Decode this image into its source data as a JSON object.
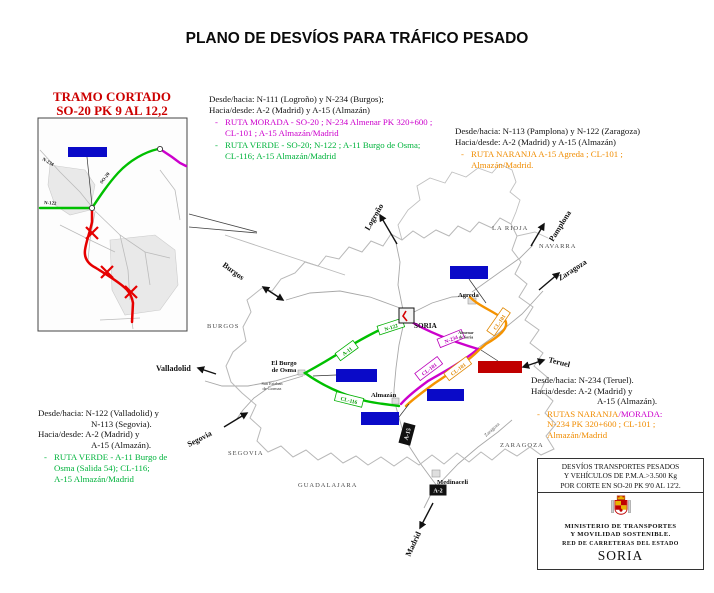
{
  "title": "PLANO DE DESVÍOS PARA TRÁFICO PESADO",
  "shared": {
    "dash": "-"
  },
  "colors": {
    "route_green": "#00c000",
    "route_magenta": "#cc00cc",
    "route_orange": "#f59300",
    "route_red": "#e60000",
    "label_blue": "#0a0ac8",
    "label_red": "#c00000",
    "title_red": "#cc0000"
  },
  "inset": {
    "title_line1": "TRAMO CORTADO",
    "title_line2": "SO-20 PK 9 AL 12,2",
    "roads": {
      "n234": "N-234",
      "n122": "N-122",
      "so20": "SO-20"
    }
  },
  "notes": {
    "north": {
      "l1": "Desde/hacia: N-111 (Logroño) y N-234 (Burgos);",
      "l2": "Hacia/desde: A-2 (Madrid) y A-15 (Almazán)",
      "magenta": [
        "RUTA MORADA - SO-20 ; N-234 Almenar PK 320+600 ;",
        "CL-101 ; A-15 Almazán/Madrid"
      ],
      "green": [
        "RUTA VERDE - SO-20; N-122 ; A-11 Burgo de Osma;",
        "CL-116; A-15 Almazán/Madrid"
      ]
    },
    "northeast": {
      "l1": "Desde/hacia: N-113 (Pamplona) y N-122 (Zaragoza)",
      "l2": "Hacia/desde: A-2 (Madrid) y A-15 (Almazán)",
      "orange": [
        "RUTA NARANJA A-15 Agreda ; CL-101 ;",
        "Almazán/Madrid."
      ]
    },
    "east": {
      "l1": "Desde/hacia: N-234 (Teruel).",
      "l2": "Hacia/desde: A-2 (Madrid) y",
      "l3": "A-15 (Almazán).",
      "rutas_orange": "RUTAS NARANJA",
      "rutas_magenta": "/MORADA:",
      "o2": "N-234 PK 320+600 ; CL-101 ;",
      "o3": "Almazán/Madrid"
    },
    "southwest": {
      "l1": "Desde/hacia: N-122 (Valladolid) y",
      "l2": "N-113 (Segovia).",
      "l3": "Hacia/desde: A-2 (Madrid) y",
      "l4": "A-15 (Almazán).",
      "green": [
        "RUTA VERDE - A-11 Burgo de",
        "Osma (Salida 54); CL-116;",
        "A-15 Almazán/Madrid"
      ]
    }
  },
  "map": {
    "provinces": {
      "burgos": "BURGOS",
      "la_rioja": "LA RIOJA",
      "navarra": "NAVARRA",
      "zaragoza": "ZARAGOZA",
      "segovia": "SEGOVIA",
      "guadalajara": "GUADALAJARA"
    },
    "directions": {
      "logrono": "Logroño",
      "pamplona": "Pamplona",
      "zaragoza": "Zaragoza",
      "burgos": "Burgos",
      "valladolid": "Valladolid",
      "segovia": "Segovia",
      "teruel": "Teruel",
      "madrid": "Madrid"
    },
    "cities": {
      "soria": "SORIA",
      "agreda": "Agreda",
      "burgo_l1": "El Burgo",
      "burgo_l2": "de Osma",
      "almazan": "Almazán",
      "medinaceli": "Medinaceli",
      "san_esteban_l1": "San Esteban",
      "san_esteban_l2": "de Gormaz",
      "almenar_l1": "Almenar",
      "almenar_l2": "de Soria",
      "zaragoza_road": "Zaragoza"
    },
    "roads": {
      "n122": "N-122",
      "a11": "A-11",
      "cl116": "CL-116",
      "n234": "N-234",
      "cl101_magenta": "CL-101",
      "cl101_orange": "CL-101",
      "cl101_orange_upper": "CL-101",
      "a15": "A-15",
      "a2": "A-2"
    }
  },
  "legend": {
    "t1": "DESVÍOS TRANSPORTES PESADOS",
    "t2": "Y VEHÍCULOS DE P.M.A.>3.500 Kg",
    "t3": "POR CORTE EN SO-20 PK 9'0 AL 12'2.",
    "ministry1": "MINISTERIO DE TRANSPORTES",
    "ministry2": "Y MOVILIDAD SOSTENIBLE.",
    "network": "RED DE CARRETERAS DEL ESTADO",
    "province": "SORIA"
  }
}
